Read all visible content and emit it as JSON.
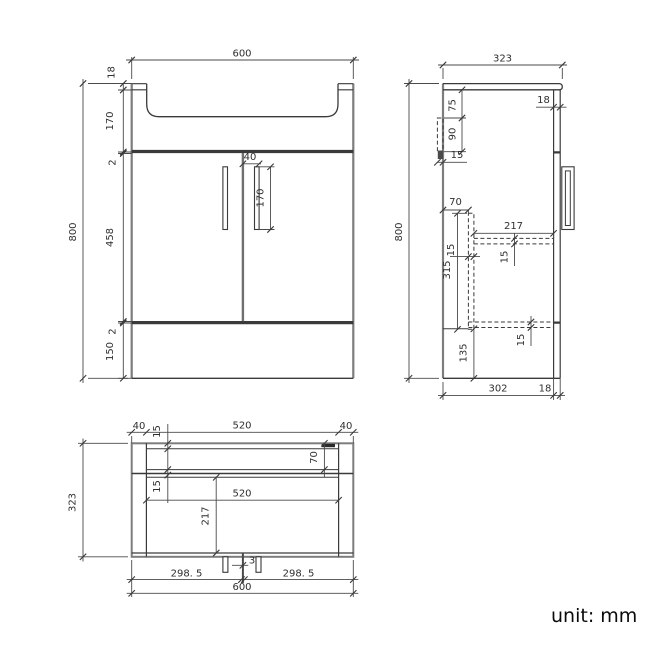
{
  "note": {
    "unit_note": "unit: mm"
  },
  "colors": {
    "line": "#3a3a3a",
    "edge": "#7d7d7d",
    "dim_text": "#2f2f2f",
    "background": "#ffffff"
  },
  "front_view": {
    "width": "600",
    "height": "800",
    "chain": [
      "18",
      "170",
      "2",
      "458",
      "2",
      "150"
    ],
    "handle_offset": "40",
    "handle_length": "170"
  },
  "side_view": {
    "depth": "323",
    "height": "800",
    "bracket_offset": "75",
    "bracket_length": "90",
    "bracket_width": "15",
    "door_thickness_top": "18",
    "divider_offset": "70",
    "interior_depth": "217",
    "shelf_thickness": "15",
    "divider_thickness": "15",
    "divider_height": "315",
    "base_height": "135",
    "bottom_shelf_thickness": "15",
    "body_depth": "302",
    "door_thickness_bottom": "18"
  },
  "plan_view": {
    "edge_left": "40",
    "basin_width": "520",
    "edge_right": "40",
    "back_rail": "15",
    "depth": "323",
    "bowl_offset": "70",
    "rim": "15",
    "interior_width": "520",
    "interior_depth": "217",
    "door_gap": "3",
    "door_left_width": "298. 5",
    "door_right_width": "298. 5",
    "total_width": "600"
  }
}
